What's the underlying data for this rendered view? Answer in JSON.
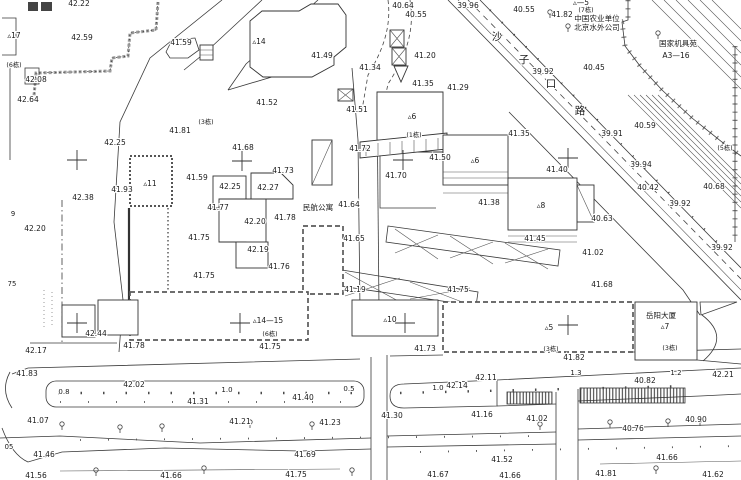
{
  "map": {
    "canvas": {
      "width": 741,
      "height": 480,
      "background": "#ffffff",
      "ink": "#3a3a3a"
    },
    "labels": [
      {
        "t": "42.22",
        "x": 79,
        "y": 6
      },
      {
        "t": "42.59",
        "x": 82,
        "y": 40
      },
      {
        "t": "42.08",
        "x": 36,
        "y": 82
      },
      {
        "t": "42.64",
        "x": 28,
        "y": 102
      },
      {
        "t": "▵17",
        "x": 14,
        "y": 38,
        "k": "bldg"
      },
      {
        "t": "(6栋)",
        "x": 14,
        "y": 67,
        "k": "unit"
      },
      {
        "t": "41.59",
        "x": 181,
        "y": 45
      },
      {
        "t": "(3栋)",
        "x": 206,
        "y": 124,
        "k": "unit"
      },
      {
        "t": "41.81",
        "x": 180,
        "y": 133
      },
      {
        "t": "42.25",
        "x": 115,
        "y": 145
      },
      {
        "t": "▵14",
        "x": 259,
        "y": 44,
        "k": "bldg"
      },
      {
        "t": "41.49",
        "x": 322,
        "y": 58
      },
      {
        "t": "41.52",
        "x": 267,
        "y": 105
      },
      {
        "t": "41.51",
        "x": 357,
        "y": 112
      },
      {
        "t": "41.34",
        "x": 370,
        "y": 70
      },
      {
        "t": "40.64",
        "x": 403,
        "y": 8
      },
      {
        "t": "40.55",
        "x": 416,
        "y": 17
      },
      {
        "t": "39.96",
        "x": 468,
        "y": 8
      },
      {
        "t": "41.20",
        "x": 425,
        "y": 58
      },
      {
        "t": "41.35",
        "x": 423,
        "y": 86
      },
      {
        "t": "41.29",
        "x": 458,
        "y": 90
      },
      {
        "t": "40.55",
        "x": 524,
        "y": 12
      },
      {
        "t": "41.82",
        "x": 562,
        "y": 17
      },
      {
        "t": "▵—5",
        "x": 581,
        "y": 5,
        "k": "bldg"
      },
      {
        "t": "(7栋)",
        "x": 586,
        "y": 12,
        "k": "unit"
      },
      {
        "t": "中国农业单位",
        "x": 597,
        "y": 21,
        "k": "name"
      },
      {
        "t": "北京水外公司",
        "x": 597,
        "y": 30,
        "k": "name"
      },
      {
        "t": "国家机具苑",
        "x": 678,
        "y": 46,
        "k": "name"
      },
      {
        "t": "A3—16",
        "x": 676,
        "y": 58,
        "k": "name"
      },
      {
        "t": "40.45",
        "x": 594,
        "y": 70
      },
      {
        "t": "39.92",
        "x": 543,
        "y": 74
      },
      {
        "t": "40.59",
        "x": 645,
        "y": 128
      },
      {
        "t": "沙",
        "x": 497,
        "y": 40,
        "k": "road"
      },
      {
        "t": "子",
        "x": 524,
        "y": 63,
        "k": "road"
      },
      {
        "t": "口",
        "x": 551,
        "y": 87,
        "k": "road"
      },
      {
        "t": "路",
        "x": 580,
        "y": 114,
        "k": "road"
      },
      {
        "t": "39.91",
        "x": 612,
        "y": 136
      },
      {
        "t": "39.94",
        "x": 641,
        "y": 167
      },
      {
        "t": "40.42",
        "x": 648,
        "y": 190
      },
      {
        "t": "39.92",
        "x": 680,
        "y": 206
      },
      {
        "t": "40.68",
        "x": 714,
        "y": 189
      },
      {
        "t": "(5栋)",
        "x": 725,
        "y": 150,
        "k": "unit"
      },
      {
        "t": "39.92",
        "x": 722,
        "y": 250
      },
      {
        "t": "40.63",
        "x": 602,
        "y": 221
      },
      {
        "t": "41.72",
        "x": 360,
        "y": 151
      },
      {
        "t": "(1栋)",
        "x": 414,
        "y": 137,
        "k": "unit"
      },
      {
        "t": "41.50",
        "x": 440,
        "y": 160
      },
      {
        "t": "41.70",
        "x": 396,
        "y": 178
      },
      {
        "t": "▵6",
        "x": 412,
        "y": 119,
        "k": "bldg"
      },
      {
        "t": "▵6",
        "x": 475,
        "y": 163,
        "k": "bldg"
      },
      {
        "t": "41.35",
        "x": 519,
        "y": 136
      },
      {
        "t": "41.38",
        "x": 489,
        "y": 205
      },
      {
        "t": "41.40",
        "x": 557,
        "y": 172
      },
      {
        "t": "▵8",
        "x": 541,
        "y": 208,
        "k": "bldg"
      },
      {
        "t": "41.45",
        "x": 535,
        "y": 241
      },
      {
        "t": "41.65",
        "x": 354,
        "y": 241
      },
      {
        "t": "41.02",
        "x": 593,
        "y": 255
      },
      {
        "t": "41.68",
        "x": 602,
        "y": 287
      },
      {
        "t": "▵11",
        "x": 150,
        "y": 186,
        "k": "bldg"
      },
      {
        "t": "41.93",
        "x": 122,
        "y": 192
      },
      {
        "t": "41.59",
        "x": 197,
        "y": 180
      },
      {
        "t": "42.25",
        "x": 230,
        "y": 189
      },
      {
        "t": "42.27",
        "x": 268,
        "y": 190
      },
      {
        "t": "41.68",
        "x": 243,
        "y": 150
      },
      {
        "t": "41.73",
        "x": 283,
        "y": 173
      },
      {
        "t": "41.77",
        "x": 218,
        "y": 210
      },
      {
        "t": "42.20",
        "x": 255,
        "y": 224
      },
      {
        "t": "41.78",
        "x": 285,
        "y": 220
      },
      {
        "t": "41.75",
        "x": 199,
        "y": 240
      },
      {
        "t": "42.19",
        "x": 258,
        "y": 252
      },
      {
        "t": "41.76",
        "x": 279,
        "y": 269
      },
      {
        "t": "41.75",
        "x": 204,
        "y": 278
      },
      {
        "t": "民航公寓",
        "x": 318,
        "y": 210,
        "k": "name"
      },
      {
        "t": "41.64",
        "x": 349,
        "y": 207
      },
      {
        "t": "42.38",
        "x": 83,
        "y": 200
      },
      {
        "t": "9",
        "x": 13,
        "y": 216,
        "k": "misc"
      },
      {
        "t": "42.20",
        "x": 35,
        "y": 231
      },
      {
        "t": "75",
        "x": 12,
        "y": 286,
        "k": "misc"
      },
      {
        "t": "42.44",
        "x": 96,
        "y": 336
      },
      {
        "t": "42.17",
        "x": 36,
        "y": 353
      },
      {
        "t": "41.78",
        "x": 134,
        "y": 348
      },
      {
        "t": "41.83",
        "x": 27,
        "y": 376
      },
      {
        "t": "0.8",
        "x": 64,
        "y": 394,
        "k": "dist"
      },
      {
        "t": "42.02",
        "x": 134,
        "y": 387
      },
      {
        "t": "1.0",
        "x": 227,
        "y": 392,
        "k": "dist"
      },
      {
        "t": "41.31",
        "x": 198,
        "y": 404
      },
      {
        "t": "41.07",
        "x": 38,
        "y": 423
      },
      {
        "t": "05",
        "x": 9,
        "y": 449,
        "k": "misc"
      },
      {
        "t": "41.46",
        "x": 44,
        "y": 457
      },
      {
        "t": "41.21",
        "x": 240,
        "y": 424
      },
      {
        "t": "41.23",
        "x": 330,
        "y": 425
      },
      {
        "t": "41.56",
        "x": 36,
        "y": 478
      },
      {
        "t": "41.66",
        "x": 171,
        "y": 478
      },
      {
        "t": "41.69",
        "x": 305,
        "y": 457
      },
      {
        "t": "41.75",
        "x": 296,
        "y": 477
      },
      {
        "t": "▵14—15",
        "x": 268,
        "y": 323,
        "k": "bldg"
      },
      {
        "t": "(6栋)",
        "x": 270,
        "y": 336,
        "k": "unit"
      },
      {
        "t": "41.75",
        "x": 270,
        "y": 349
      },
      {
        "t": "▵10",
        "x": 390,
        "y": 322,
        "k": "bldg"
      },
      {
        "t": "41.73",
        "x": 425,
        "y": 351
      },
      {
        "t": "41.19",
        "x": 355,
        "y": 292
      },
      {
        "t": "41.75",
        "x": 458,
        "y": 292
      },
      {
        "t": "0.5",
        "x": 349,
        "y": 391,
        "k": "dist"
      },
      {
        "t": "41.40",
        "x": 303,
        "y": 400
      },
      {
        "t": "1.0",
        "x": 438,
        "y": 390,
        "k": "dist"
      },
      {
        "t": "42.14",
        "x": 457,
        "y": 388
      },
      {
        "t": "42.11",
        "x": 486,
        "y": 380
      },
      {
        "t": "41.30",
        "x": 392,
        "y": 418
      },
      {
        "t": "41.16",
        "x": 482,
        "y": 417
      },
      {
        "t": "41.67",
        "x": 438,
        "y": 477
      },
      {
        "t": "41.66",
        "x": 510,
        "y": 478
      },
      {
        "t": "▵5",
        "x": 549,
        "y": 330,
        "k": "bldg"
      },
      {
        "t": "(3栋)",
        "x": 551,
        "y": 351,
        "k": "unit"
      },
      {
        "t": "41.82",
        "x": 574,
        "y": 360
      },
      {
        "t": "1.3",
        "x": 576,
        "y": 375,
        "k": "dist"
      },
      {
        "t": "1.2",
        "x": 676,
        "y": 375,
        "k": "dist"
      },
      {
        "t": "42.21",
        "x": 723,
        "y": 377
      },
      {
        "t": "40.82",
        "x": 645,
        "y": 383
      },
      {
        "t": "41.02",
        "x": 537,
        "y": 421
      },
      {
        "t": "40.90",
        "x": 696,
        "y": 422
      },
      {
        "t": "40.76",
        "x": 633,
        "y": 431
      },
      {
        "t": "41.52",
        "x": 502,
        "y": 462
      },
      {
        "t": "41.66",
        "x": 667,
        "y": 460
      },
      {
        "t": "41.81",
        "x": 606,
        "y": 476
      },
      {
        "t": "41.62",
        "x": 713,
        "y": 477
      },
      {
        "t": "岳阳大厦",
        "x": 661,
        "y": 318,
        "k": "name"
      },
      {
        "t": "▵7",
        "x": 665,
        "y": 329,
        "k": "bldg"
      },
      {
        "t": "(3栋)",
        "x": 670,
        "y": 350,
        "k": "unit"
      }
    ]
  }
}
